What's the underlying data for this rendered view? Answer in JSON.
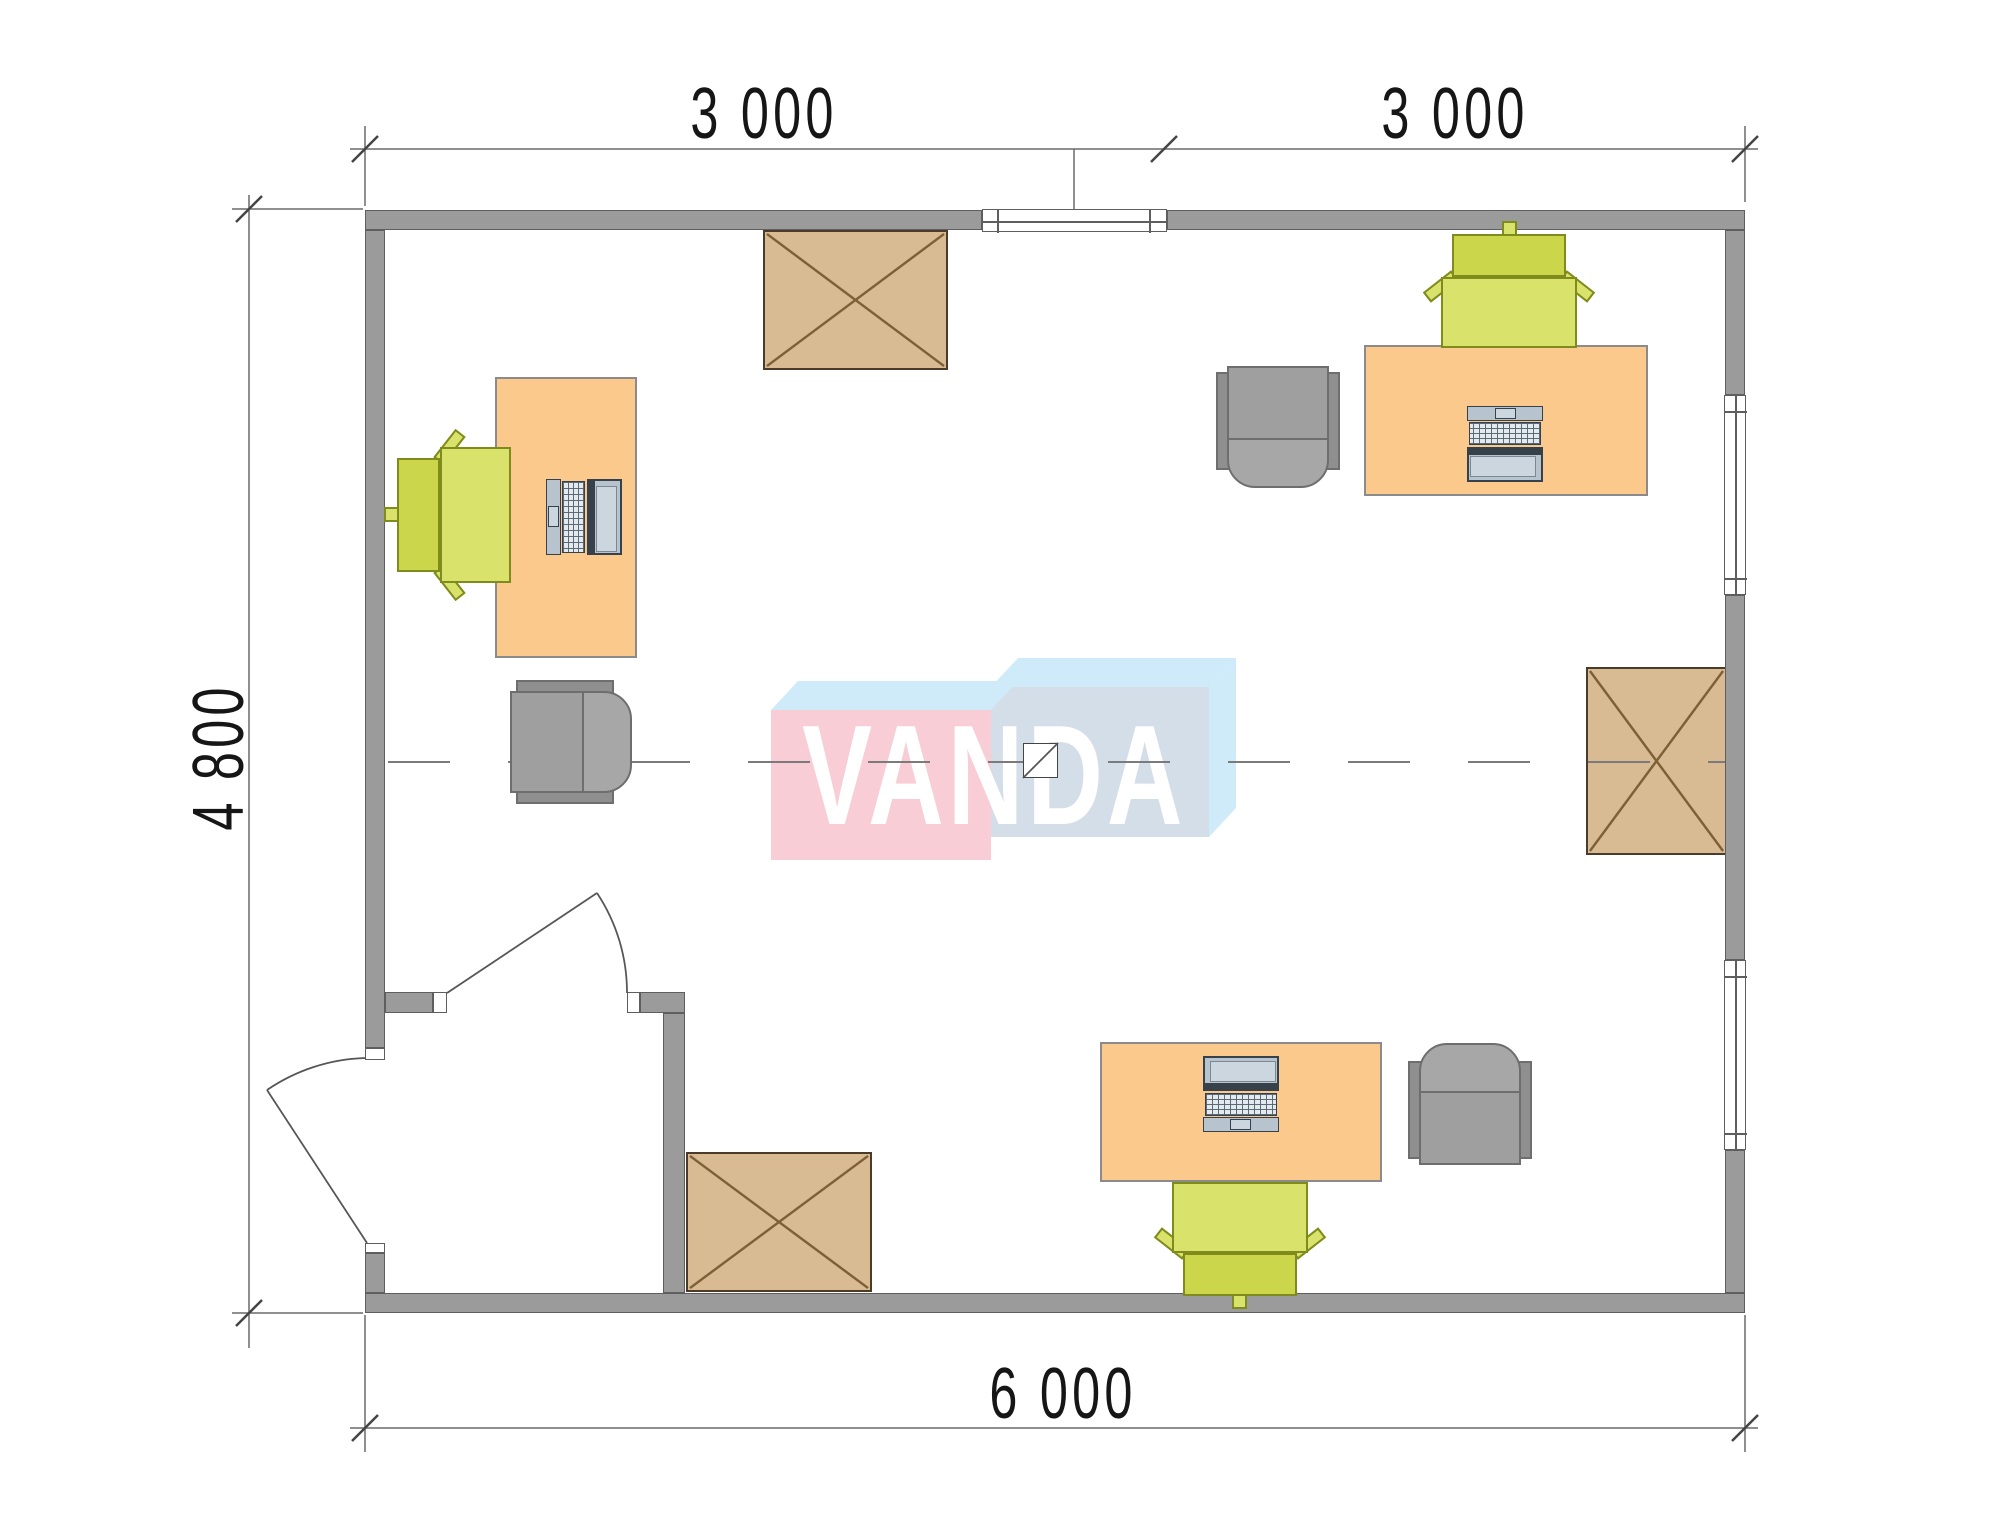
{
  "dimensions": {
    "top_left_span": "3 000",
    "top_right_span": "3 000",
    "left_span": "4 800",
    "bottom_span": "6 000"
  },
  "watermark": {
    "logo_text": "VANDA"
  },
  "plan": {
    "type": "office floor plan, top view",
    "room_width_mm": 6000,
    "room_depth_mm": 4800,
    "center_symbol": "junction-box with diagonal on axis line",
    "furniture": [
      {
        "item": "desk with laptop",
        "position": "left wall"
      },
      {
        "item": "green task chair",
        "position": "left desk, facing east"
      },
      {
        "item": "gray guest chair",
        "position": "below left desk, facing east"
      },
      {
        "item": "storage crate (X top)",
        "position": "top center, against top wall"
      },
      {
        "item": "desk with laptop",
        "position": "top right"
      },
      {
        "item": "green task chair",
        "position": "top-right desk, backrest to top wall"
      },
      {
        "item": "gray guest chair",
        "position": "left of top-right desk, facing south"
      },
      {
        "item": "storage crate (X top)",
        "position": "right wall, mid height"
      },
      {
        "item": "desk with laptop",
        "position": "bottom right"
      },
      {
        "item": "green task chair",
        "position": "below bottom desk, backrest to bottom wall"
      },
      {
        "item": "gray guest chair",
        "position": "right of bottom desk, facing north"
      },
      {
        "item": "storage crate (X top)",
        "position": "bottom left, beside vestibule wall"
      },
      {
        "item": "hinged door",
        "position": "exterior door in left wall, swings outward"
      },
      {
        "item": "hinged door",
        "position": "vestibule interior door, swings into room"
      },
      {
        "item": "window",
        "position": "top wall"
      },
      {
        "item": "window",
        "position": "right wall, upper"
      },
      {
        "item": "window",
        "position": "right wall, lower"
      }
    ]
  },
  "colors": {
    "wall": "#9b9b9b",
    "wall-line": "#5e5e5e",
    "desk": "#fbc98b",
    "desk-line": "#8b8b8b",
    "chair-green": "#d9e26b",
    "chair-green-back": "#ccd64b",
    "chair-green-line": "#7f8b1c",
    "chair-gray": "#9f9f9f",
    "chair-gray-dark": "#8f8f8f",
    "chair-gray-light": "#a7a7a7",
    "chair-gray-line": "#6e6e6e",
    "wood": "#d8bb92",
    "wood-line": "#4a3c28",
    "wood-cross": "#7d5f38",
    "laptop-dark": "#37414b",
    "laptop-body": "#b7c3cd",
    "laptop-screen": "#ccd6de",
    "dim-line": "#6a6a6a",
    "dim-text": "#161616",
    "centerline": "#7b7b7b",
    "logo-pink": "#f8cdd6",
    "logo-blue": "#cfeaf8",
    "logo-blue-face": "#d4dee8",
    "logo-text-color": "#ffffff"
  }
}
